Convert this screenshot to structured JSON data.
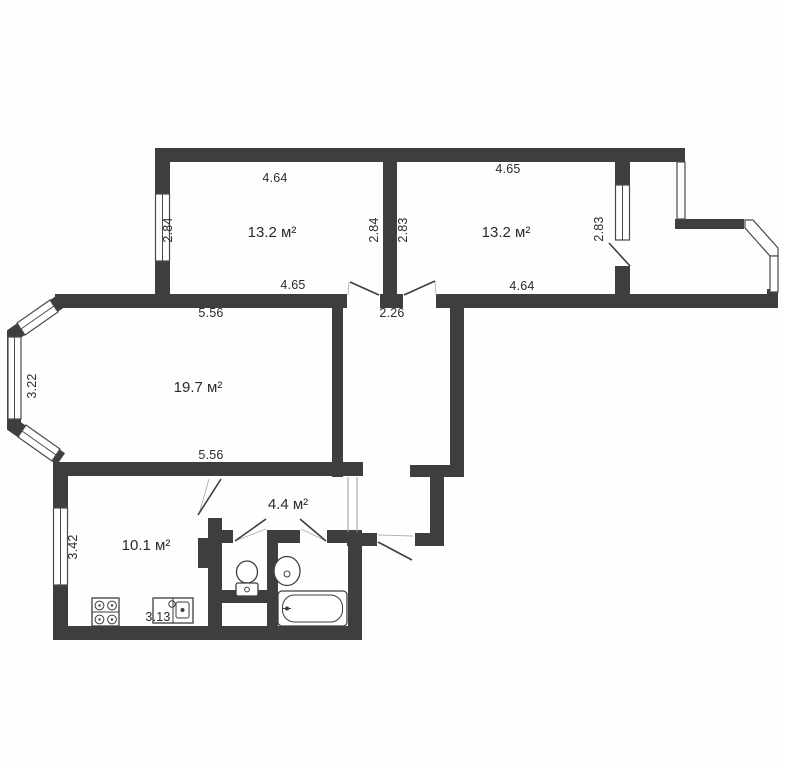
{
  "plan": {
    "type": "apartment-floor-plan",
    "colors": {
      "wall": "#3e3e3e",
      "background": "#ffffff",
      "label": "#2b2b2b"
    },
    "rooms": [
      {
        "name": "bedroom-left",
        "area": "13.2 м²",
        "dims": {
          "top": "4.64",
          "bottom": "4.65",
          "left": "2.84",
          "right": "2.84"
        }
      },
      {
        "name": "bedroom-right",
        "area": "13.2 м²",
        "dims": {
          "top": "4.65",
          "bottom": "4.64",
          "left": "2.83",
          "right": "2.83"
        }
      },
      {
        "name": "living-room",
        "area": "19.7 м²",
        "dims": {
          "top": "5.56",
          "bottom": "5.56",
          "left": "3.22"
        }
      },
      {
        "name": "kitchen",
        "area": "10.1 м²",
        "dims": {
          "left": "3.42",
          "bottom": "3.13"
        }
      },
      {
        "name": "hallway",
        "area": "4.4 м²",
        "dims": {}
      },
      {
        "name": "corridor",
        "area": "",
        "dims": {
          "width": "2.26"
        }
      }
    ],
    "fixtures": [
      "stove",
      "kitchen-sink",
      "toilet",
      "wash-basin",
      "bathtub"
    ],
    "features": [
      "bay-window",
      "balcony",
      "entrance-door"
    ]
  }
}
